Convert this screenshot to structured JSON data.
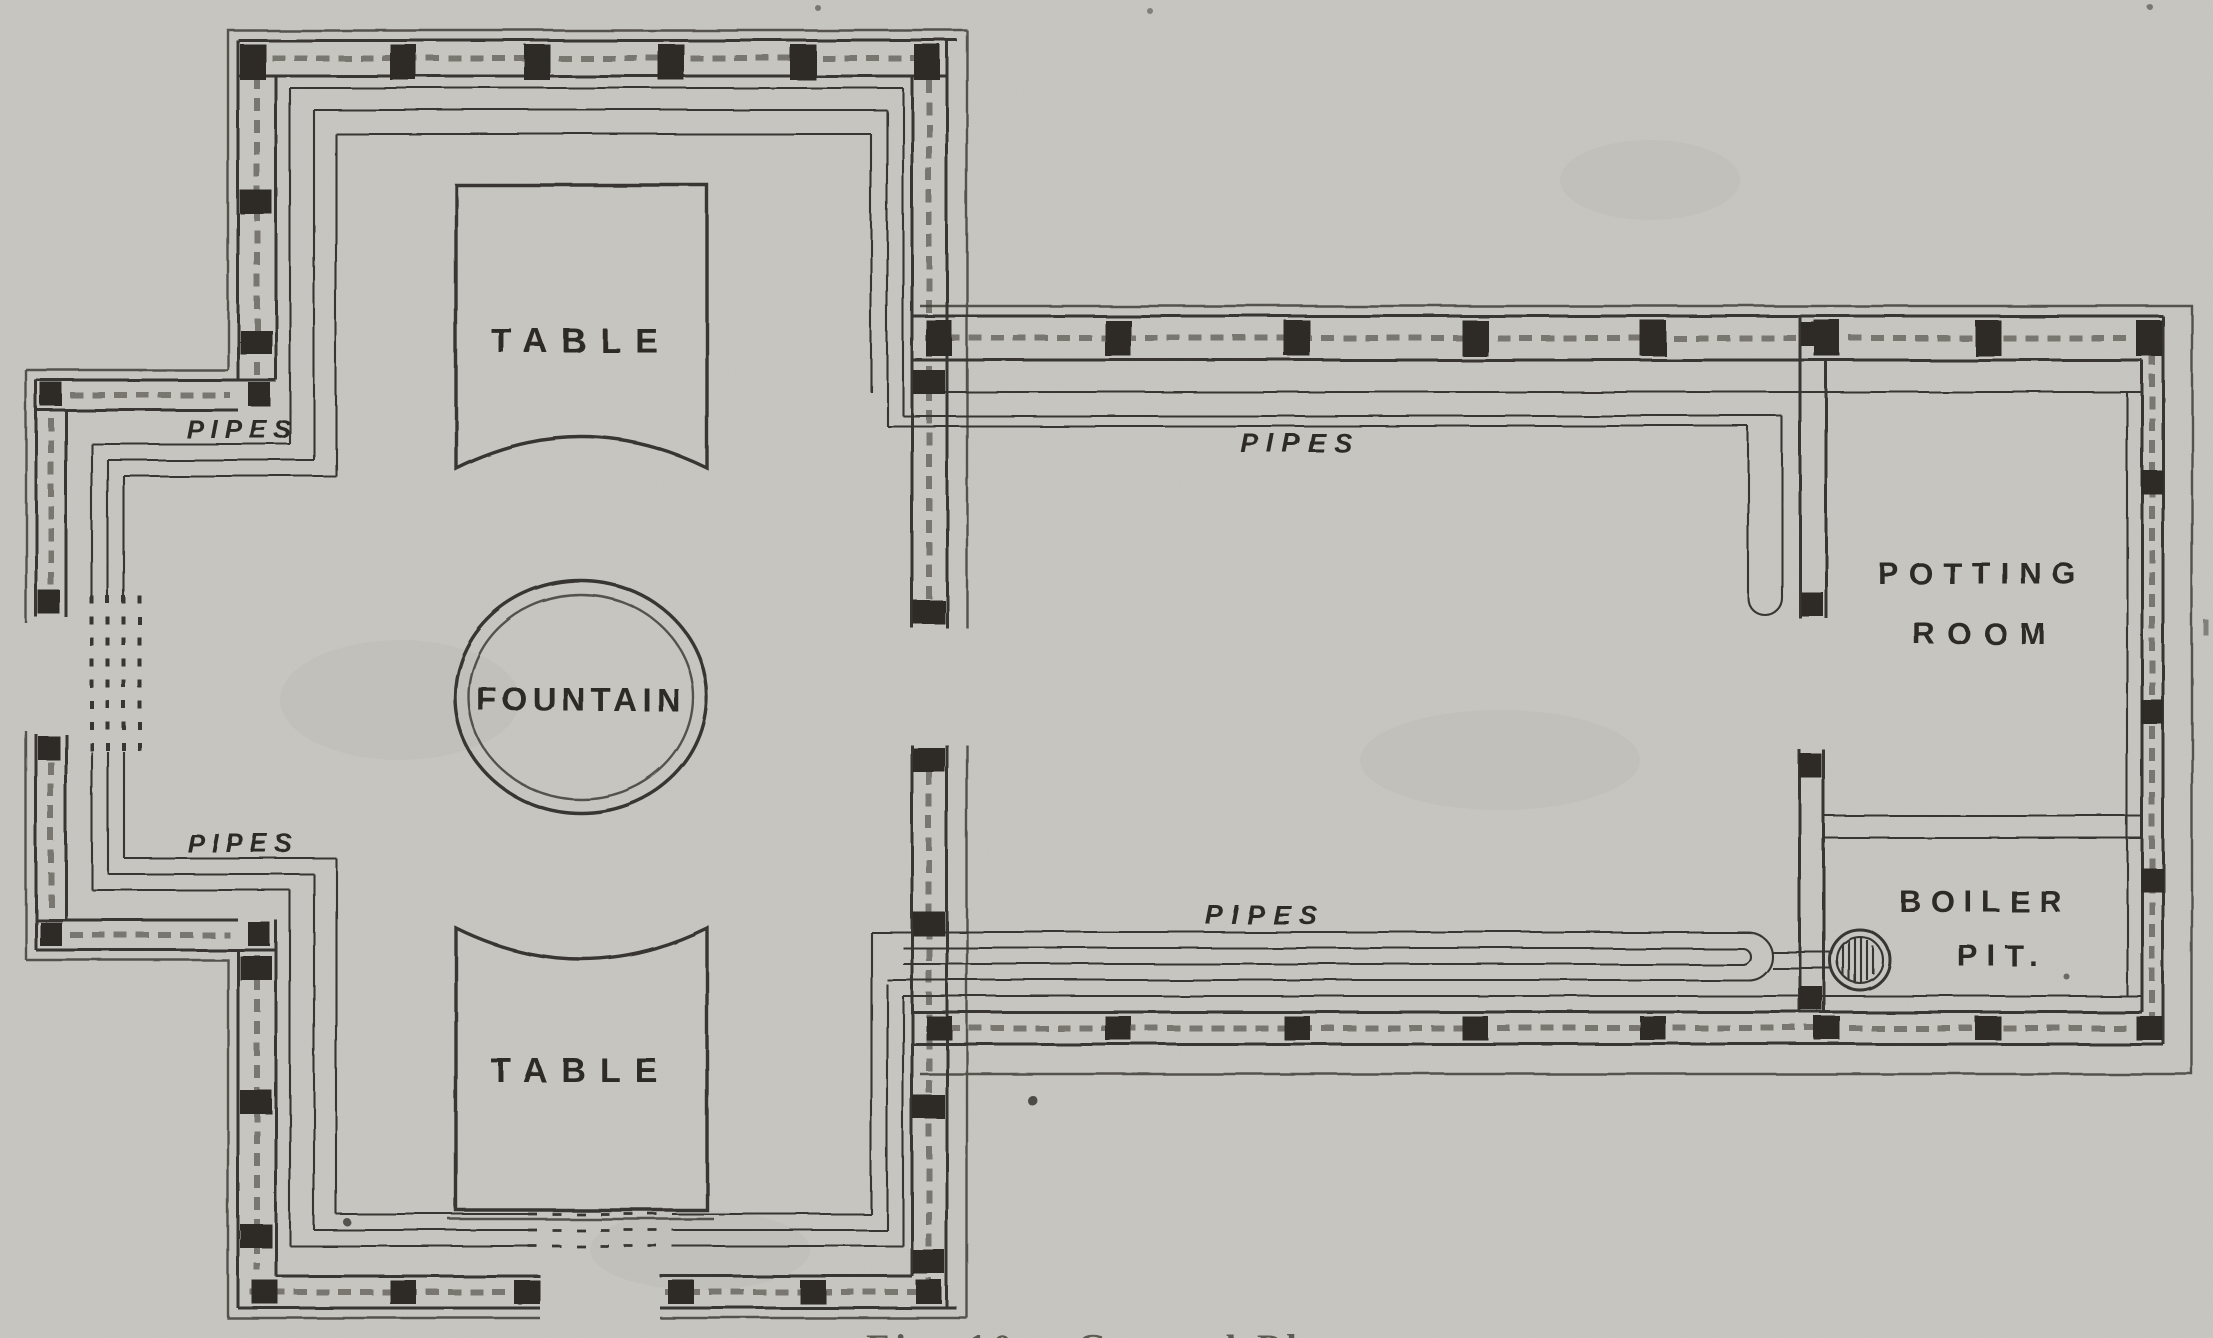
{
  "figure": {
    "colors": {
      "paper": "#c8c7c1",
      "ink": "#393631",
      "post": "#2e2b27",
      "label": "#2f2c27"
    },
    "labels": {
      "table_top": "TABLE",
      "table_bottom": "TABLE",
      "fountain": "FOUNTAIN",
      "pipes_house_upper": "PIPES",
      "pipes_house_lower": "PIPES",
      "pipes_top_wing": "PIPES",
      "pipes_bottom_wing": "PIPES",
      "potting_room_line1": "POTTING",
      "potting_room_line2": "ROOM",
      "boiler_pit_line1": "BOILER",
      "boiler_pit_line2": "PIT.",
      "caption_partial": "Fig. 10.—Ground Plan"
    }
  }
}
